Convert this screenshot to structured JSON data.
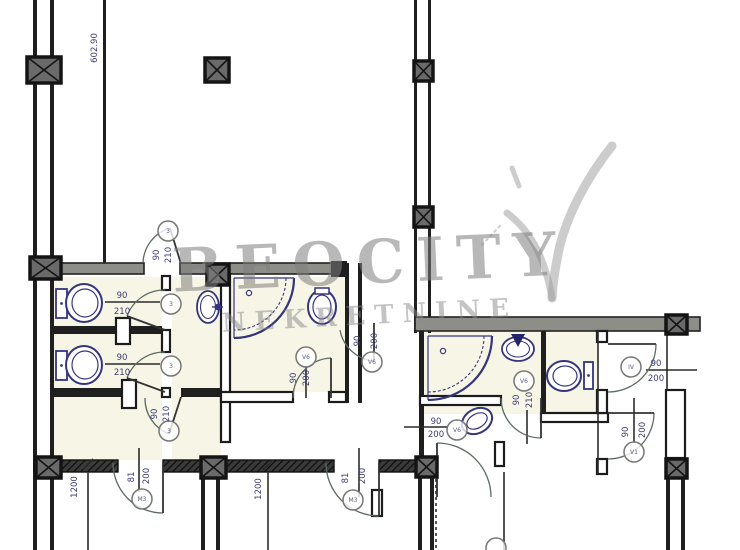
{
  "canvas": {
    "width": 740,
    "height": 550,
    "background": "#ffffff"
  },
  "watermark": {
    "line1": "BEOCITY",
    "line2": "NEKRETNINE"
  },
  "colors": {
    "wall": "#1f1f1f",
    "wall_grey": "#8e8e88",
    "line": "#2b2b2b",
    "arc": "#5c6b60",
    "leaf": "#333333",
    "fixture": "#35357e",
    "dim": "#3c3c74",
    "bubble_stroke": "#777777",
    "bubble_glyph": "#5a5a86",
    "tint": "#f6f5e6",
    "watermark": "#9a9a9a",
    "column_fill": "#6a6a6a",
    "column_frame": "#141414"
  },
  "plan": {
    "tints": [
      [
        54,
        277,
        108,
        183
      ],
      [
        172,
        277,
        49,
        183
      ],
      [
        231,
        277,
        114,
        115
      ],
      [
        421,
        332,
        176,
        82
      ],
      [
        547,
        332,
        50,
        80
      ]
    ],
    "walls": [
      {
        "r": [
          33,
          0,
          4,
          550
        ],
        "s": "solid"
      },
      {
        "r": [
          50,
          0,
          4,
          550
        ],
        "s": "solid"
      },
      {
        "r": [
          103,
          0,
          3,
          264
        ],
        "s": "solid"
      },
      {
        "r": [
          414,
          0,
          3,
          333
        ],
        "s": "solid"
      },
      {
        "r": [
          428,
          0,
          3,
          333
        ],
        "s": "solid"
      },
      {
        "r": [
          52,
          263,
          92,
          11
        ],
        "s": "grey"
      },
      {
        "r": [
          180,
          263,
          166,
          11
        ],
        "s": "grey"
      },
      {
        "r": [
          331,
          261,
          16,
          16
        ],
        "s": "solid"
      },
      {
        "r": [
          221,
          274,
          9,
          168
        ],
        "s": "outline"
      },
      {
        "r": [
          345,
          263,
          4,
          140
        ],
        "s": "solid"
      },
      {
        "r": [
          358,
          263,
          4,
          140
        ],
        "s": "solid"
      },
      {
        "r": [
          162,
          276,
          8,
          14
        ],
        "s": "outline"
      },
      {
        "r": [
          162,
          330,
          8,
          22
        ],
        "s": "outline"
      },
      {
        "r": [
          162,
          388,
          8,
          9
        ],
        "s": "outline"
      },
      {
        "r": [
          52,
          326,
          110,
          8
        ],
        "s": "solid"
      },
      {
        "r": [
          116,
          318,
          14,
          26
        ],
        "s": "outline"
      },
      {
        "r": [
          52,
          388,
          84,
          9
        ],
        "s": "solid"
      },
      {
        "r": [
          122,
          380,
          14,
          28
        ],
        "s": "outline"
      },
      {
        "r": [
          181,
          388,
          40,
          9
        ],
        "s": "solid"
      },
      {
        "r": [
          221,
          392,
          72,
          10
        ],
        "s": "outline"
      },
      {
        "r": [
          329,
          392,
          17,
          10
        ],
        "s": "outline"
      },
      {
        "r": [
          415,
          317,
          285,
          14
        ],
        "s": "grey"
      },
      {
        "r": [
          419,
          331,
          5,
          129
        ],
        "s": "solid"
      },
      {
        "r": [
          420,
          396,
          81,
          9
        ],
        "s": "outline"
      },
      {
        "r": [
          541,
          331,
          5,
          83
        ],
        "s": "solid"
      },
      {
        "r": [
          541,
          413,
          67,
          9
        ],
        "s": "outline"
      },
      {
        "r": [
          597,
          331,
          10,
          11
        ],
        "s": "outline"
      },
      {
        "r": [
          597,
          390,
          10,
          23
        ],
        "s": "outline"
      },
      {
        "r": [
          597,
          459,
          10,
          15
        ],
        "s": "outline"
      },
      {
        "r": [
          666,
          390,
          19,
          68
        ],
        "s": "outline"
      },
      {
        "r": [
          372,
          490,
          10,
          26
        ],
        "s": "outline"
      },
      {
        "r": [
          495,
          442,
          9,
          24
        ],
        "s": "outline"
      },
      {
        "r": [
          418,
          477,
          4,
          73
        ],
        "s": "solid"
      },
      {
        "r": [
          430,
          477,
          4,
          73
        ],
        "s": "solid"
      },
      {
        "r": [
          201,
          478,
          4,
          72
        ],
        "s": "solid"
      },
      {
        "r": [
          216,
          478,
          4,
          72
        ],
        "s": "solid"
      },
      {
        "r": [
          666,
          478,
          4,
          72
        ],
        "s": "solid"
      },
      {
        "r": [
          681,
          478,
          4,
          72
        ],
        "s": "solid"
      },
      {
        "r": [
          34,
          460,
          84,
          12
        ],
        "s": "hatch"
      },
      {
        "r": [
          163,
          460,
          171,
          12
        ],
        "s": "hatch"
      },
      {
        "r": [
          379,
          460,
          58,
          12
        ],
        "s": "hatch"
      }
    ],
    "columns": [
      [
        27,
        57,
        34,
        26
      ],
      [
        205,
        58,
        24,
        24
      ],
      [
        414,
        61,
        19,
        20
      ],
      [
        414,
        207,
        19,
        20
      ],
      [
        30,
        257,
        31,
        22
      ],
      [
        207,
        264,
        22,
        21
      ],
      [
        666,
        315,
        21,
        19
      ],
      [
        36,
        457,
        25,
        21
      ],
      [
        201,
        457,
        25,
        21
      ],
      [
        416,
        457,
        21,
        20
      ],
      [
        666,
        459,
        21,
        19
      ]
    ],
    "lines": [
      {
        "p": [
          105,
          302,
          160,
          302
        ]
      },
      {
        "p": [
          105,
          364,
          160,
          364
        ]
      },
      {
        "p": [
          646,
          370,
          697,
          370
        ]
      },
      {
        "p": [
          404,
          427,
          447,
          427
        ]
      },
      {
        "p": [
          306,
          366,
          306,
          398
        ]
      },
      {
        "p": [
          359,
          448,
          359,
          497
        ]
      },
      {
        "p": [
          139,
          448,
          139,
          492
        ]
      },
      {
        "p": [
          634,
          398,
          634,
          443
        ]
      },
      {
        "p": [
          527,
          410,
          527,
          444
        ]
      },
      {
        "p": [
          83,
          469,
          93,
          459
        ]
      },
      {
        "p": [
          263,
          470,
          273,
          460
        ]
      },
      {
        "p": [
          88,
          472,
          88,
          550
        ]
      },
      {
        "p": [
          268,
          472,
          268,
          550
        ]
      },
      {
        "p": [
          504,
          472,
          504,
          550
        ]
      },
      {
        "p": [
          667,
          334,
          667,
          390
        ]
      },
      {
        "p": [
          598,
          331,
          598,
          474
        ]
      },
      {
        "p": [
          436,
          479,
          436,
          550
        ],
        "dash": "3,3"
      }
    ],
    "doors": [
      {
        "leaf": [
          165,
          330,
          127,
          316
        ],
        "arc": "M127,316 A40,40 0 0 1 165,290"
      },
      {
        "leaf": [
          165,
          392,
          127,
          378
        ],
        "arc": "M127,378 A40,40 0 0 1 165,352"
      },
      {
        "leaf": [
          181,
          264,
          170,
          228
        ],
        "arc": "M170,228 A38,38 0 0 0 143,262"
      },
      {
        "leaf": [
          181,
          397,
          169,
          434
        ],
        "arc": "M169,434 A38,38 0 0 1 145,398"
      },
      {
        "leaf": [
          331,
          398,
          331,
          358
        ],
        "arc": "M331,358 A40,40 0 0 0 293,398"
      },
      {
        "leaf": [
          374,
          323,
          374,
          361
        ],
        "arc": "M374,361 A38,38 0 0 1 340,330"
      },
      {
        "leaf": [
          541,
          398,
          541,
          438
        ],
        "arc": "M541,438 A40,40 0 0 1 501,398"
      },
      {
        "leaf": [
          608,
          344,
          656,
          344
        ],
        "arc": "M656,344 A48,48 0 0 1 608,392"
      },
      {
        "leaf": [
          608,
          413,
          654,
          413
        ],
        "arc": "M654,413 A46,46 0 0 1 608,459"
      },
      {
        "leaf": [
          163,
          463,
          163,
          513
        ],
        "arc": "M163,513 A50,50 0 0 1 113,463"
      },
      {
        "leaf": [
          379,
          463,
          379,
          516
        ],
        "arc": "M379,516 A53,53 0 0 1 326,463"
      },
      {
        "leaf": [
          437,
          497,
          437,
          443
        ],
        "arc": "M437,443 A54,54 0 0 1 491,497"
      }
    ],
    "fixtures": [
      {
        "type": "toilet",
        "tank": [
          56,
          289,
          11,
          29
        ],
        "bowl": [
          84,
          303,
          18,
          19
        ]
      },
      {
        "type": "toilet",
        "tank": [
          56,
          351,
          11,
          29
        ],
        "bowl": [
          84,
          365,
          18,
          19
        ]
      },
      {
        "type": "toilet",
        "tank": [
          584,
          362,
          9,
          27
        ],
        "bowl": [
          564,
          376,
          17,
          15
        ]
      },
      {
        "type": "sink",
        "c": [
          208,
          307
        ],
        "rx": 11,
        "ry": 16,
        "faucet": [
          218,
          307
        ]
      },
      {
        "type": "sink2",
        "c": [
          518,
          349
        ],
        "rx": 16,
        "ry": 12,
        "tri": [
          [
            511,
            334
          ],
          [
            525,
            334
          ],
          [
            518,
            347
          ]
        ]
      },
      {
        "type": "shower",
        "corner": [
          234,
          278
        ],
        "r1": 60,
        "r2": 52
      },
      {
        "type": "shower",
        "corner": [
          428,
          336
        ],
        "r1": 64,
        "r2": 56
      },
      {
        "type": "oval",
        "c": [
          322,
          307
        ],
        "rx": 14,
        "ry": 17,
        "rot": 0,
        "cap": [
          315,
          288,
          14,
          6
        ]
      },
      {
        "type": "oval",
        "c": [
          477,
          421
        ],
        "rx": 16,
        "ry": 12,
        "rot": -30
      }
    ],
    "bubbles": [
      {
        "x": 171,
        "y": 304,
        "g": "3"
      },
      {
        "x": 171,
        "y": 366,
        "g": "3"
      },
      {
        "x": 168,
        "y": 231,
        "g": "3"
      },
      {
        "x": 169,
        "y": 431,
        "g": "3"
      },
      {
        "x": 306,
        "y": 357,
        "g": "V6"
      },
      {
        "x": 372,
        "y": 362,
        "g": "V6"
      },
      {
        "x": 524,
        "y": 381,
        "g": "V6"
      },
      {
        "x": 631,
        "y": 367,
        "g": "IV"
      },
      {
        "x": 634,
        "y": 452,
        "g": "V1"
      },
      {
        "x": 457,
        "y": 430,
        "g": "V6"
      },
      {
        "x": 142,
        "y": 499,
        "g": "M3"
      },
      {
        "x": 353,
        "y": 500,
        "g": "M3"
      },
      {
        "x": 496,
        "y": 548,
        "g": ""
      }
    ],
    "labels": [
      {
        "t": "602.90",
        "x": 97,
        "y": 48,
        "r": -90
      },
      {
        "t": "90",
        "x": 122,
        "y": 298
      },
      {
        "t": "210",
        "x": 122,
        "y": 314
      },
      {
        "t": "90",
        "x": 122,
        "y": 360
      },
      {
        "t": "210",
        "x": 122,
        "y": 375
      },
      {
        "t": "90",
        "x": 159,
        "y": 255,
        "r": -90
      },
      {
        "t": "210",
        "x": 171,
        "y": 255,
        "r": -90
      },
      {
        "t": "90",
        "x": 157,
        "y": 414,
        "r": -90
      },
      {
        "t": "210",
        "x": 169,
        "y": 414,
        "r": -90
      },
      {
        "t": "90",
        "x": 296,
        "y": 378,
        "r": -90
      },
      {
        "t": "200",
        "x": 309,
        "y": 378,
        "r": -90
      },
      {
        "t": "90",
        "x": 360,
        "y": 341,
        "r": -90
      },
      {
        "t": "200",
        "x": 377,
        "y": 341,
        "r": -90
      },
      {
        "t": "90",
        "x": 519,
        "y": 400,
        "r": -90
      },
      {
        "t": "210",
        "x": 532,
        "y": 400,
        "r": -90
      },
      {
        "t": "90",
        "x": 656,
        "y": 366
      },
      {
        "t": "200",
        "x": 656,
        "y": 381
      },
      {
        "t": "90",
        "x": 628,
        "y": 432,
        "r": -90
      },
      {
        "t": "200",
        "x": 645,
        "y": 430,
        "r": -90
      },
      {
        "t": "90",
        "x": 436,
        "y": 424
      },
      {
        "t": "200",
        "x": 436,
        "y": 437
      },
      {
        "t": "81",
        "x": 134,
        "y": 477,
        "r": -90
      },
      {
        "t": "200",
        "x": 149,
        "y": 476,
        "r": -90
      },
      {
        "t": "81",
        "x": 348,
        "y": 478,
        "r": -90
      },
      {
        "t": "200",
        "x": 365,
        "y": 476,
        "r": -90
      },
      {
        "t": "1200",
        "x": 77,
        "y": 487,
        "r": -90
      },
      {
        "t": "1200",
        "x": 261,
        "y": 489,
        "r": -90
      }
    ],
    "logo_marks": [
      {
        "d": "M612,146 C585,180 568,215 560,245 C556,263 553,281 552,298",
        "w": 9
      },
      {
        "d": "M552,298 C545,258 531,231 507,213",
        "w": 7
      },
      {
        "d": "M512,168 L519,186",
        "w": 5
      },
      {
        "d": "M500,226 L480,247",
        "w": 2,
        "dash": "2,4"
      }
    ]
  }
}
